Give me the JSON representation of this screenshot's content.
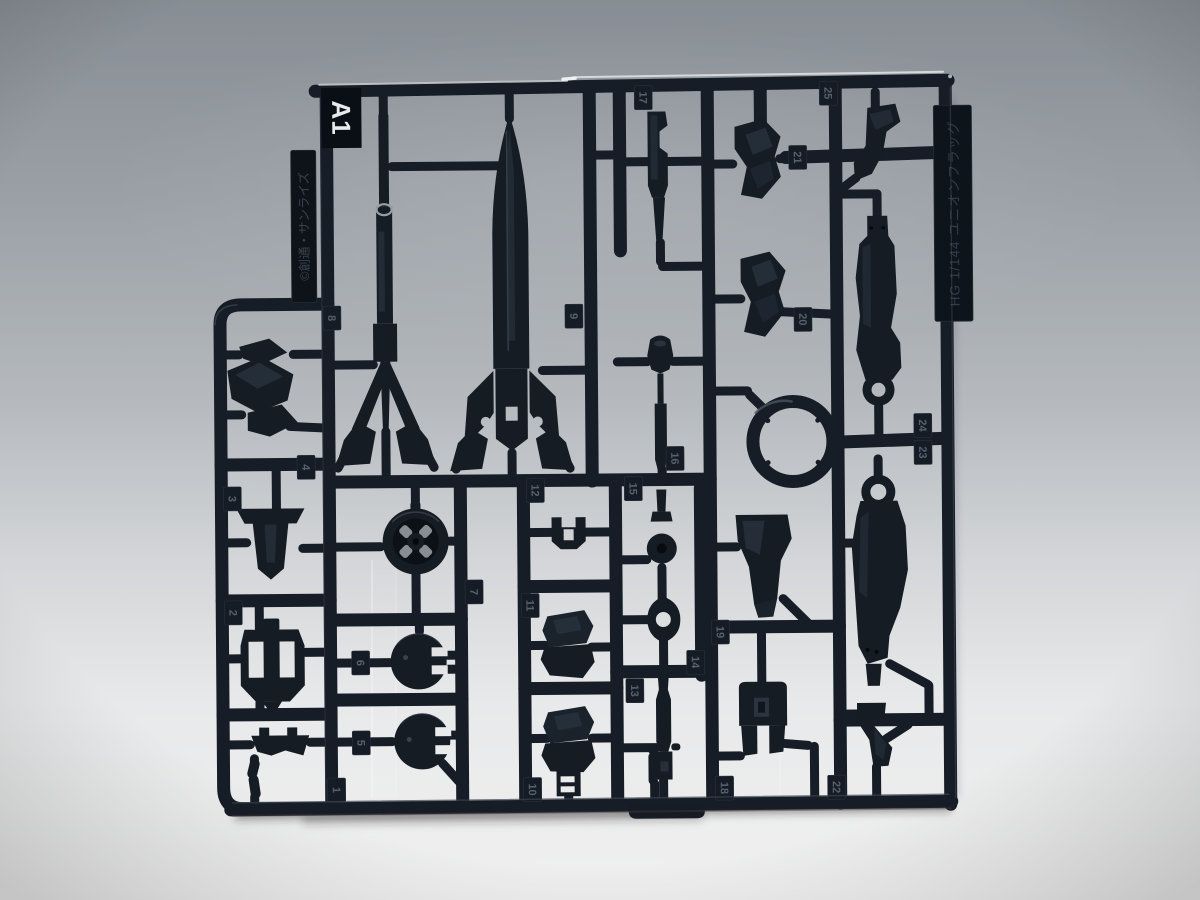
{
  "labels": {
    "runner_code": "A1",
    "copyright": "©創通・サンライズ",
    "product_name": "HG 1/144 ユニオンフラッグ"
  },
  "colors": {
    "plastic_dark": "#151c24",
    "plastic_mid": "#1d252f",
    "plastic_highlight": "#4a545f",
    "background_top": "#878d94",
    "background_bottom": "#f0f0f0",
    "tab_bg": "#151c25",
    "tab_text": "#56616d",
    "runner_code_text": "#e8eaec"
  },
  "part_numbers": [
    {
      "label": "1",
      "x": 334,
      "y": 788
    },
    {
      "label": "2",
      "x": 232,
      "y": 610
    },
    {
      "label": "3",
      "x": 232,
      "y": 496
    },
    {
      "label": "4",
      "x": 306,
      "y": 465
    },
    {
      "label": "5",
      "x": 359,
      "y": 741
    },
    {
      "label": "6",
      "x": 359,
      "y": 661
    },
    {
      "label": "7",
      "x": 473,
      "y": 591
    },
    {
      "label": "8",
      "x": 333,
      "y": 316
    },
    {
      "label": "9",
      "x": 575,
      "y": 316
    },
    {
      "label": "10",
      "x": 530,
      "y": 789
    },
    {
      "label": "11",
      "x": 529,
      "y": 605
    },
    {
      "label": "12",
      "x": 535,
      "y": 490
    },
    {
      "label": "13",
      "x": 633,
      "y": 691
    },
    {
      "label": "14",
      "x": 694,
      "y": 663
    },
    {
      "label": "15",
      "x": 633,
      "y": 489
    },
    {
      "label": "16",
      "x": 675,
      "y": 459
    },
    {
      "label": "17",
      "x": 646,
      "y": 98
    },
    {
      "label": "18",
      "x": 722,
      "y": 789
    },
    {
      "label": "19",
      "x": 719,
      "y": 633
    },
    {
      "label": "20",
      "x": 804,
      "y": 321
    },
    {
      "label": "21",
      "x": 800,
      "y": 159
    },
    {
      "label": "22",
      "x": 834,
      "y": 789
    },
    {
      "label": "23",
      "x": 923,
      "y": 455
    },
    {
      "label": "24",
      "x": 923,
      "y": 428
    },
    {
      "label": "25",
      "x": 831,
      "y": 95
    }
  ]
}
